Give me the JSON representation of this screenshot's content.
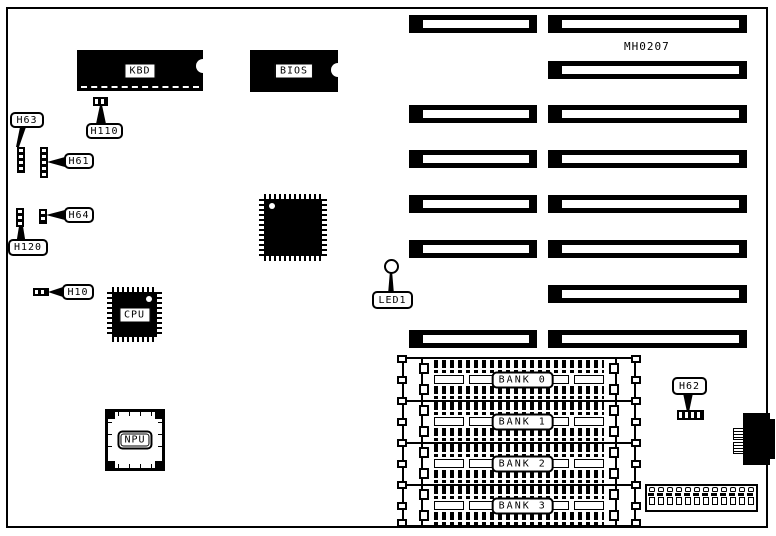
{
  "board": {
    "part_number": "MH0207",
    "chips": {
      "kbd": "KBD",
      "bios": "BIOS",
      "cpu": "CPU",
      "npu": "NPU"
    },
    "connector_callouts": {
      "h63": "H63",
      "h110": "H110",
      "h61": "H61",
      "h64": "H64",
      "h120": "H120",
      "h10": "H10",
      "h62": "H62"
    },
    "led_callouts": {
      "led1": "LED1"
    },
    "memory_banks": {
      "bank0": "BANK 0",
      "bank1": "BANK 1",
      "bank2": "BANK 2",
      "bank3": "BANK 3"
    }
  }
}
